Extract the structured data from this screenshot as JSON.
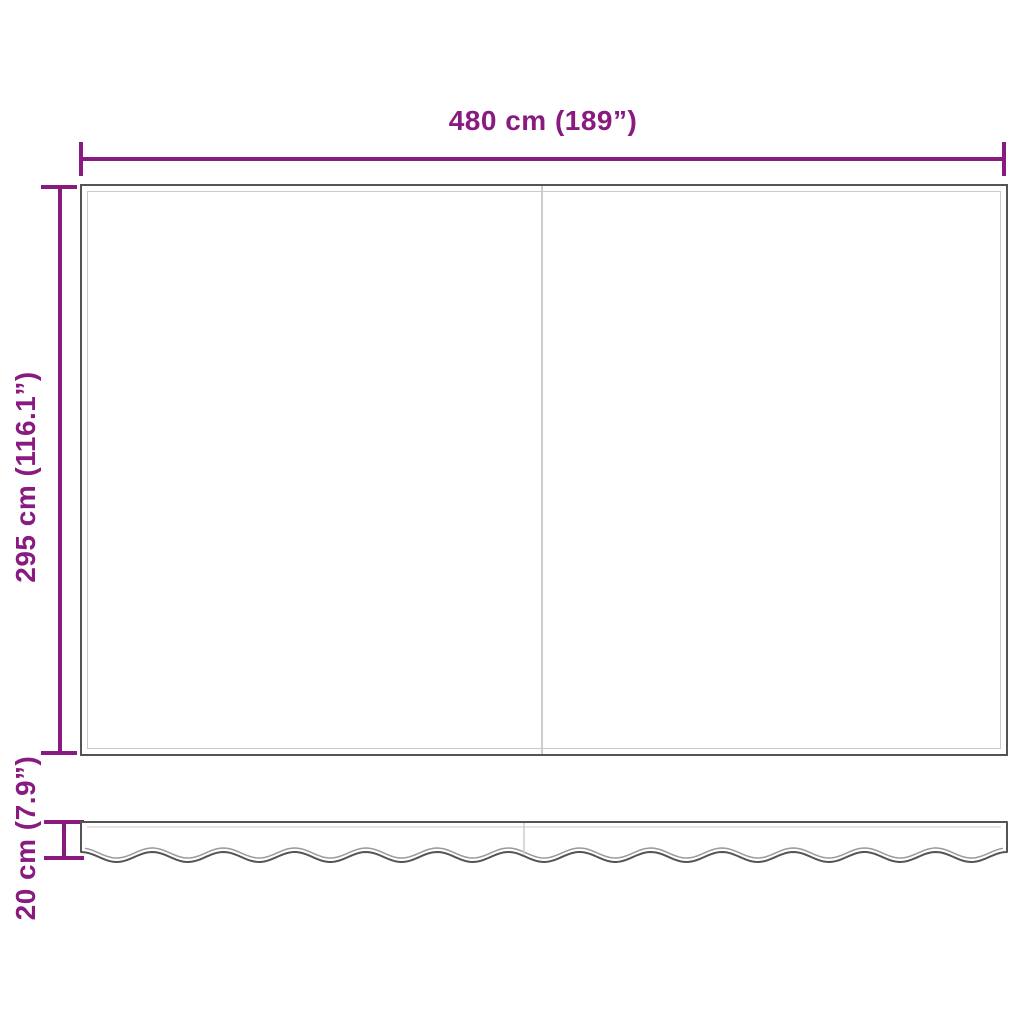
{
  "diagram": {
    "width_dimension": {
      "label": "480 cm (189”)"
    },
    "height_dimension": {
      "label": "295 cm (116.1”)"
    },
    "valance_dimension": {
      "label": "20 cm (7.9”)"
    },
    "colors": {
      "background": "#ffffff",
      "dimension": "#881a80",
      "outline": "#545454",
      "hem": "#c9c9c9",
      "seam": "#cccccc",
      "wave_hem": "#9a9a9a"
    }
  }
}
